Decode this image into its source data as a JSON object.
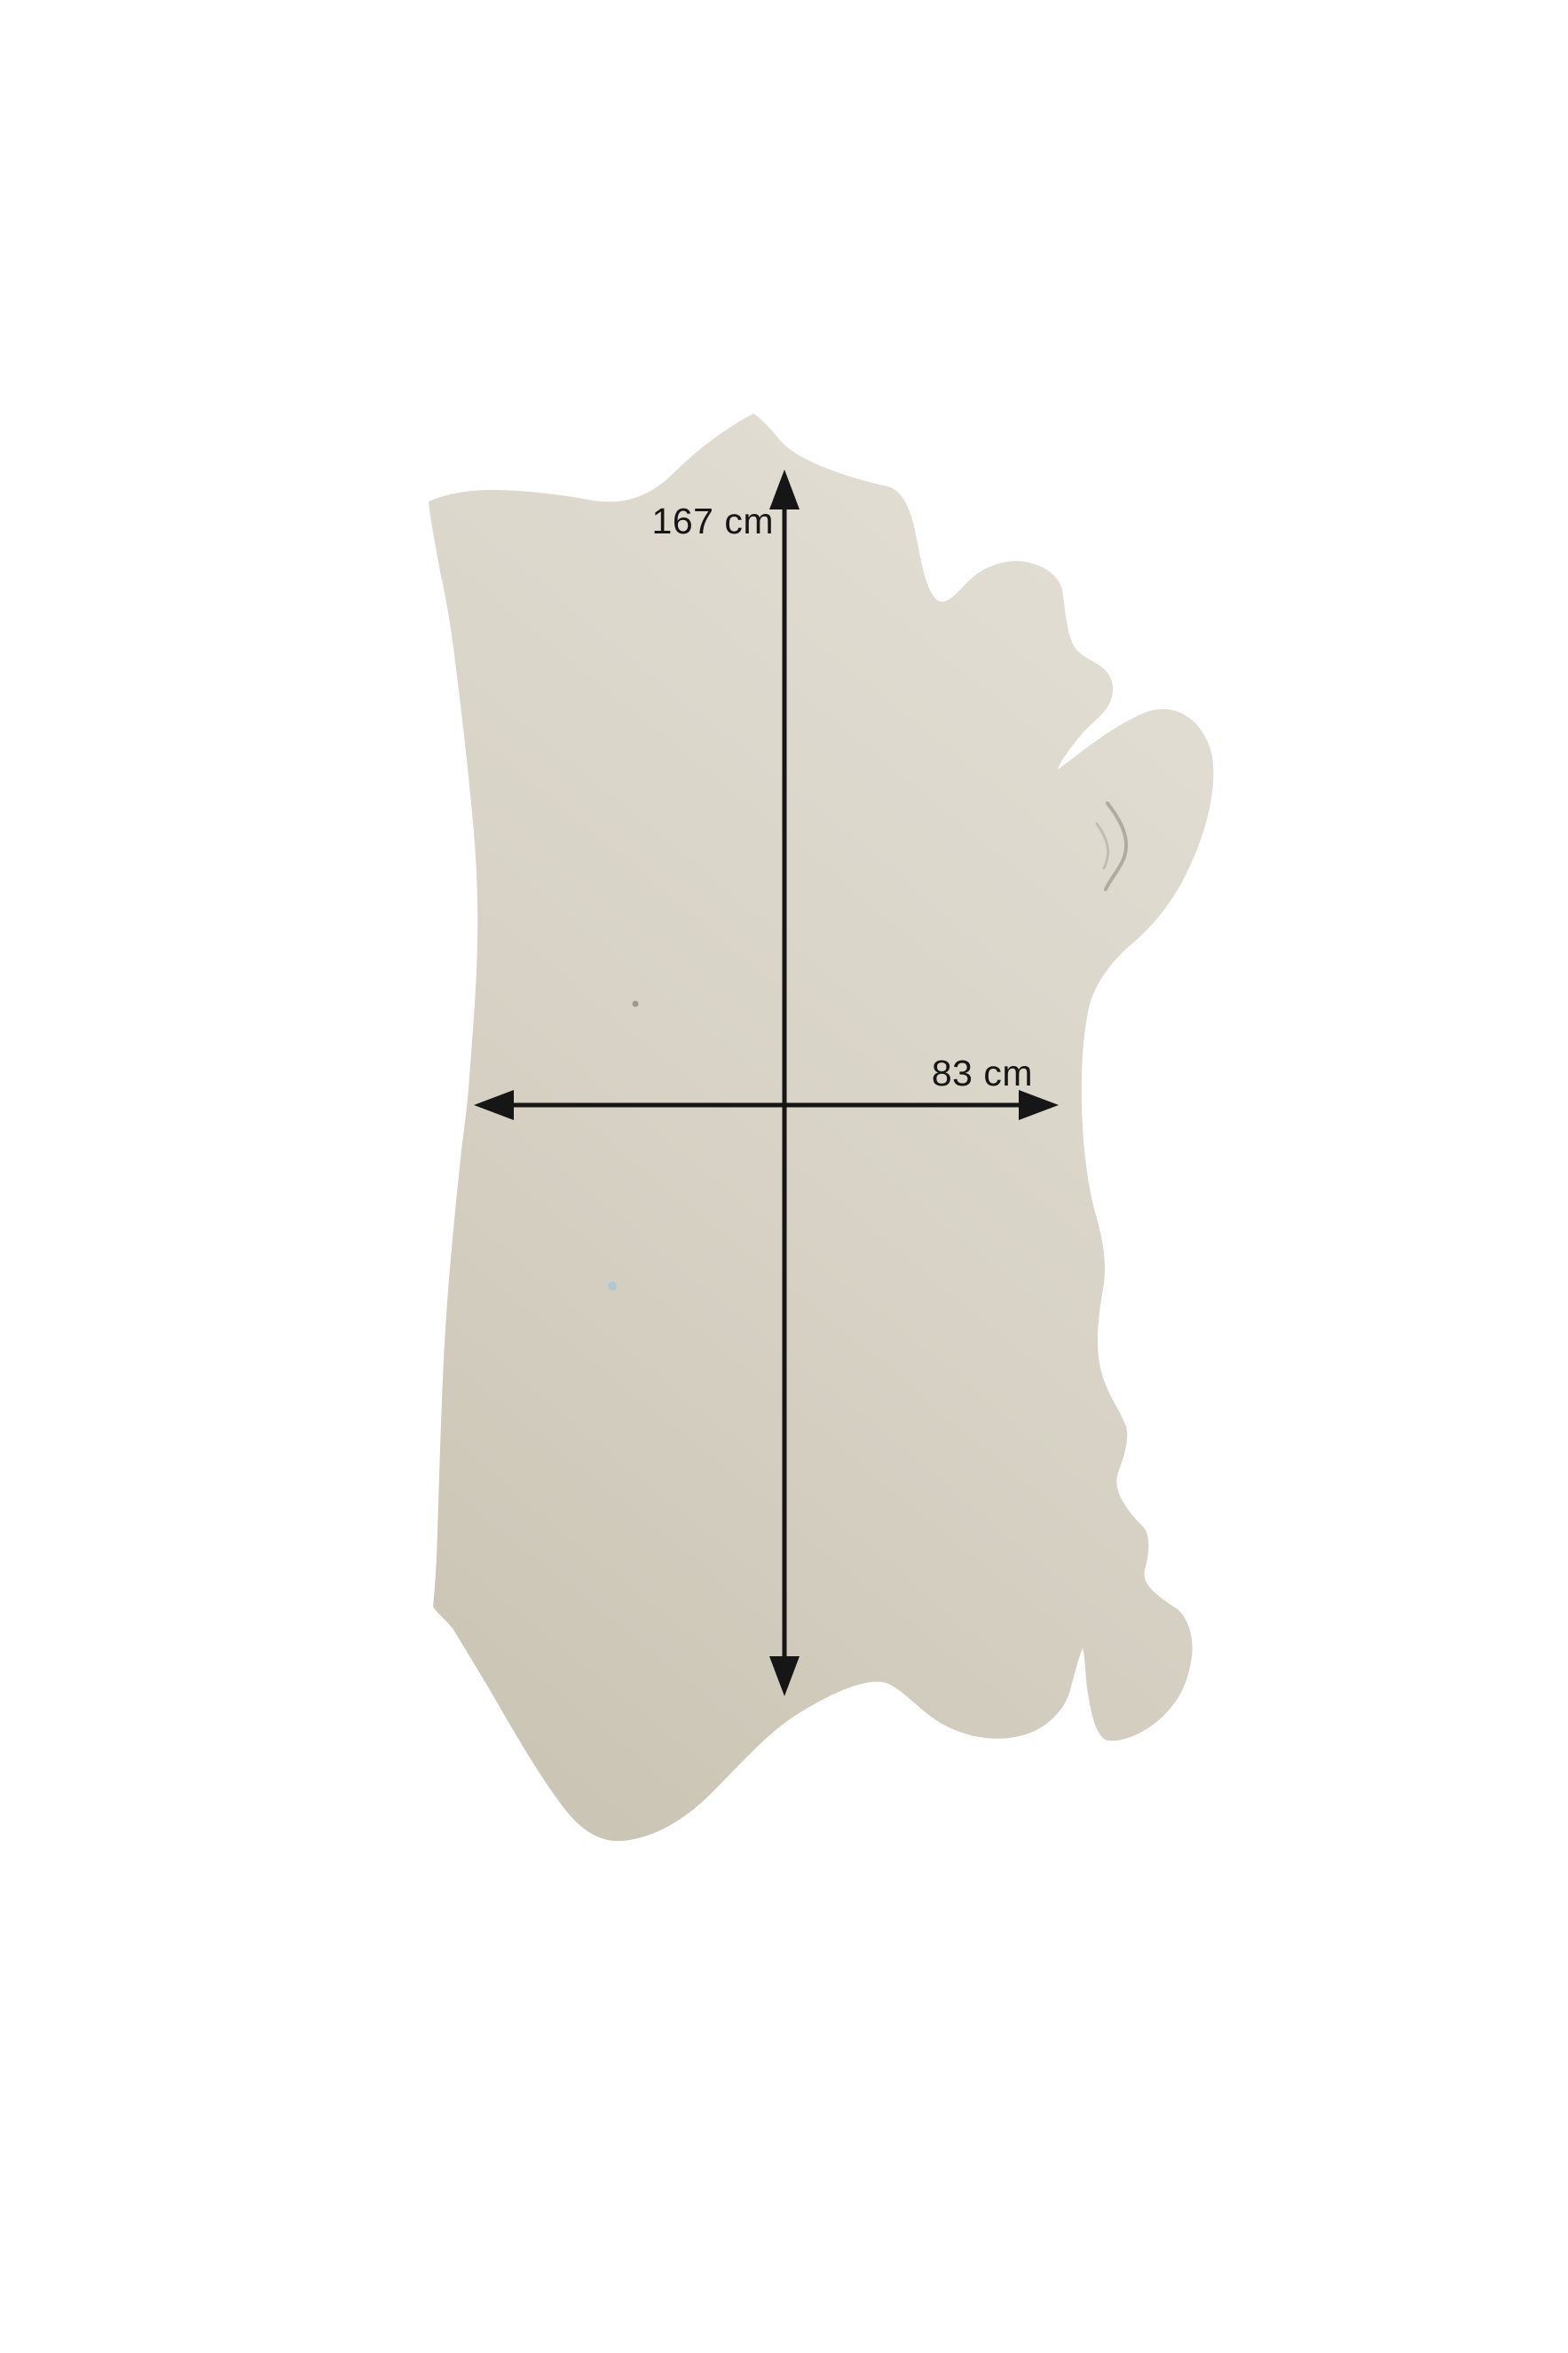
{
  "page": {
    "background_color": "#ffffff"
  },
  "product_photo": {
    "subject": "leather-hide-cutout-photo",
    "hide_color_light": "#e2ded4",
    "hide_color_mid": "#d7d2c5",
    "hide_color_dark": "#cbc5b5",
    "crease_color": "#7a7263",
    "speck_blue_color": "#a6c6da",
    "speck_dark_color": "#6f6a5f"
  },
  "annotations": {
    "color": "#161616",
    "height": {
      "label": "167 cm"
    },
    "width": {
      "label": "83 cm"
    }
  }
}
